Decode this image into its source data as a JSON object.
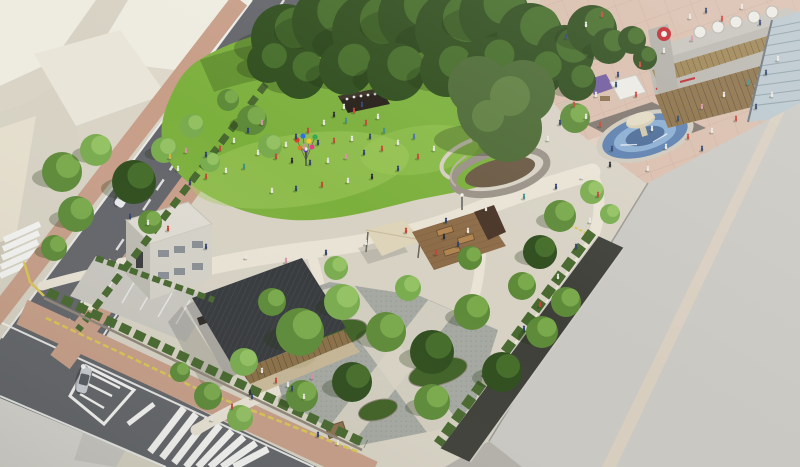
{
  "scene": {
    "type": "architectural-aerial-rendering",
    "elements": [
      "event-lawn",
      "performance-stage",
      "balloon-cluster",
      "ring-tree-plaza",
      "shade-sail",
      "wood-deck-terrace",
      "cafe-pavilion",
      "white-office-building",
      "parking-lot",
      "fountain-plaza",
      "shopping-mall",
      "escalator",
      "market-tents",
      "massing-buildings",
      "roads",
      "zebra-crossings",
      "street-trees",
      "hedges",
      "people"
    ]
  },
  "colors": {
    "base_paving": "#d7d2c4",
    "path_light": "#e9e3d5",
    "plaza_tile": "#d9bead",
    "plaza_grid": "#c6a192",
    "upper_pavement": "#eae8e3",
    "road": "#63656a",
    "road_mark": "#f4f4f2",
    "sidewalk_brick": "#c79e88",
    "tactile_yellow": "#d9c553",
    "lawn": "#7cb03d",
    "lawn_light": "#a3cd5f",
    "lawn_shade": "#4c7426",
    "tree_dark": "#2f4d1d",
    "tree_dark_hi": "#456c29",
    "tree_mid": "#5d8a38",
    "tree_mid_hi": "#79a94b",
    "tree_light": "#79ab4e",
    "tree_light_hi": "#93c162",
    "tree_olive": "#4d6a35",
    "tree_olive_hi": "#5f7f41",
    "hedge": "#47682e",
    "building_white": "#eeebe0",
    "building_white_shade": "#d9d4c6",
    "building_gray": "#cac8c2",
    "roof_dark": "#36393c",
    "wall_gray": "#a9a6a0",
    "glass_warm": "#8a6f46",
    "deck_wood": "#8d6c49",
    "deck_wall": "#4a3628",
    "canopy_sail": "#ded4b9",
    "fountain_water": "#5b7fae",
    "fountain_water_lt": "#8fb3d6",
    "fountain_stone": "#cfc5aa",
    "stone_wall": "#8f8678",
    "cobble": "#a4a8a1",
    "logo_red": "#c0272d",
    "tent_purple": "#6f5a9c",
    "tent_white": "#eceae4",
    "car_blue": "#24419f",
    "car_white": "#e9eaec",
    "car_silver": "#c9ccd1"
  }
}
